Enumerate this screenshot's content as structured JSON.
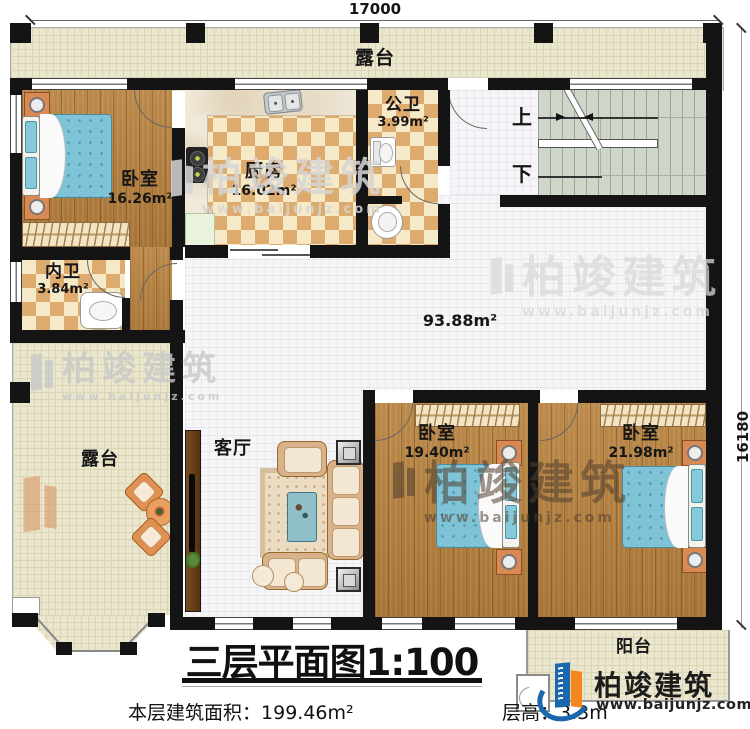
{
  "meta": {
    "title_prefix": "三层平面图",
    "scale": "1:100",
    "area_label": "本层建筑面积：",
    "area_value": "199.46m²",
    "floor_height_label": "层高：",
    "floor_height_value": "3.3m"
  },
  "dimensions": {
    "top": "17000",
    "right": "16180"
  },
  "rooms": {
    "terrace_top": "露台",
    "terrace_left": "露台",
    "balcony": "阳台",
    "living": "客厅",
    "hall_area": "93.88m²",
    "bedroom1": {
      "name": "卧室",
      "area": "16.26m²"
    },
    "kitchen": {
      "name": "厨房",
      "area": "16.02m²"
    },
    "public_bath": {
      "name": "公卫",
      "area": "3.99m²"
    },
    "inner_bath": {
      "name": "内卫",
      "area": "3.84m²"
    },
    "bedroom2": {
      "name": "卧室",
      "area": "19.40m²"
    },
    "bedroom3": {
      "name": "卧室",
      "area": "21.98m²"
    }
  },
  "stairs": {
    "up": "上",
    "down": "下"
  },
  "brand": {
    "name": "柏竣建筑",
    "url": "www.baijunjz.com"
  },
  "watermark": {
    "name": "柏竣建筑",
    "url": "www.baijunjz.com"
  },
  "colors": {
    "brand_blue": "#1a67ad",
    "brand_orange": "#f5871f",
    "wall": "#141414",
    "wood": "#b0803f",
    "tile_tan": "#ddab6e",
    "terrace": "#ebe7cf"
  }
}
